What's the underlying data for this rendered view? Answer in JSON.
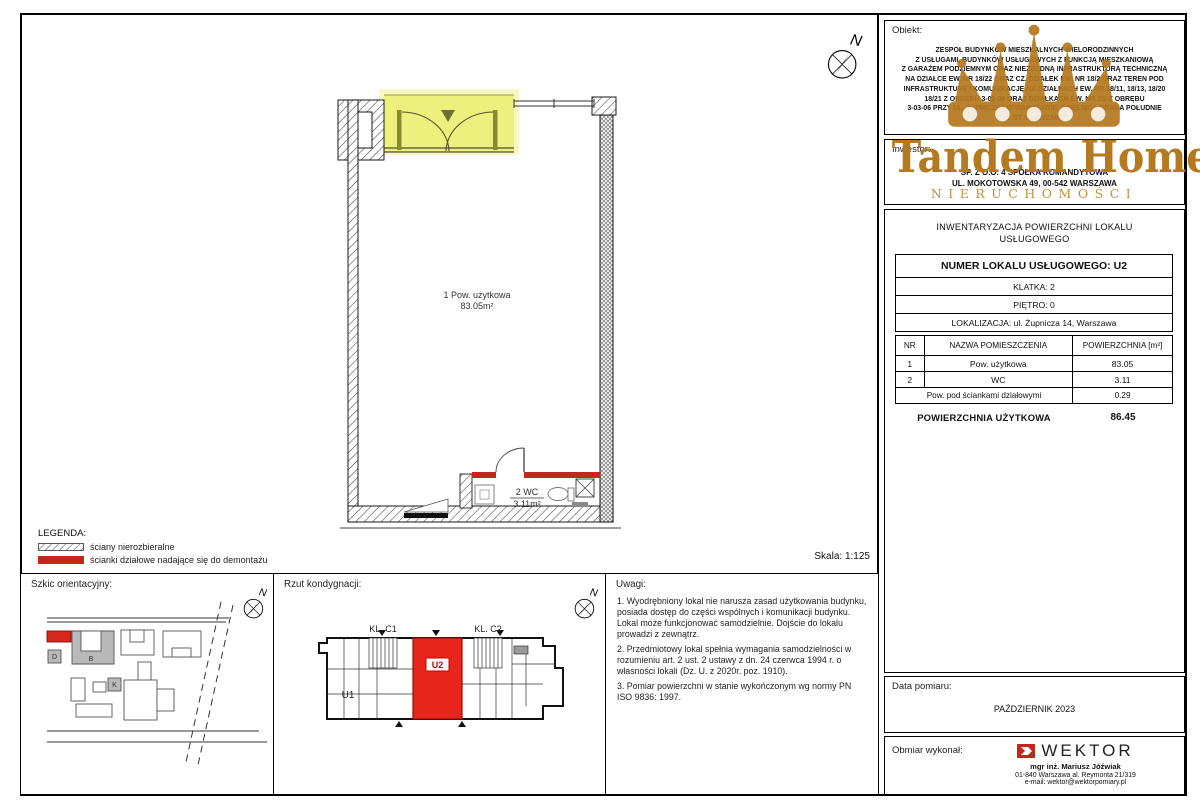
{
  "page": {
    "scale_label": "Skala: 1:125"
  },
  "colors": {
    "accent_red": "#c1271b",
    "unit_red": "#e8251a",
    "highlight_yellow": "#edf07c",
    "brand_gold": "#b5791f"
  },
  "obiekt": {
    "label": "Obiekt:",
    "lines": [
      "ZESPÓŁ BUDYNKÓW MIESZKALNYCH WIELORODZINNYCH",
      "Z USŁUGAMI, BUDYNKÓW USŁUGOWYCH Z FUNKCJĄ MIESZKANIOWĄ",
      "Z GARAŻEM PODZIEMNYM ORAZ NIEZBĘDNĄ INFRASTRUKTURĄ TECHNICZNĄ",
      "NA DZIAŁCE EW. NR 18/22 ORAZ CZ. DZIAŁEK EW. NR 18/2 ORAZ TEREN POD",
      "INFRASTRUKTURĘ I KOMUNIKACJĘ NA DZIAŁKACH EW. NR 18/11, 18/13, 18/20",
      "18/21 Z OBRĘBU 3-02-06 ORAZ DZIAŁKACH EW. NR 2/2 Z OBRĘBU",
      "3-03-06 PRZY UL. ŻUPNICZEJ W WARSZAWIE, DZIELNICA PRAGA POŁUDNIE",
      "M. ST. WARSZAWY"
    ]
  },
  "inwestor": {
    "label": "Inwestor:",
    "lines": [
      "SP. Z O.O. 4 SPÓŁKA KOMANDYTOWA",
      "UL. MOKOTOWSKA 49, 00-542 WARSZAWA"
    ]
  },
  "brand": {
    "wordmark": "Tandem Home IQ",
    "subtitle": "NIERUCHOMOŚCI"
  },
  "inventory": {
    "heading_line1": "INWENTARYZACJA POWIERZCHNI LOKALU",
    "heading_line2": "USŁUGOWEGO",
    "unit_header": "NUMER LOKALU USŁUGOWEGO: U2",
    "info_rows": [
      "KLATKA: 2",
      "PIĘTRO: 0",
      "LOKALIZACJA: ul. Żupnicza 14, Warszawa"
    ],
    "table": {
      "headers": [
        "NR",
        "NAZWA POMIESZCZENIA",
        "POWIERZCHNIA [m²]"
      ],
      "rows": [
        {
          "nr": "1",
          "name": "Pow. użytkowa",
          "area": "83.05"
        },
        {
          "nr": "2",
          "name": "WC",
          "area": "3.11"
        }
      ],
      "partition_row": {
        "name": "Pow. pod ściankami działowymi",
        "area": "0.29"
      },
      "total": {
        "label": "POWIERZCHNIA UŻYTKOWA",
        "value": "86.45"
      }
    }
  },
  "plan": {
    "north": "N",
    "room1_line1": "1 Pow. użytkowa",
    "room1_line2": "83.05m²",
    "room2_line1": "2 WC",
    "room2_line2": "3.11m²"
  },
  "legend": {
    "title": "LEGENDA:",
    "items": [
      {
        "label": "ściany nierozbieralne"
      },
      {
        "label": "ścianki działowe nadające się do demontażu"
      }
    ]
  },
  "szkic": {
    "title": "Szkic orientacyjny:",
    "labels": {
      "b": "B",
      "d": "D",
      "k": "K"
    }
  },
  "rzut": {
    "title": "Rzut kondygnacji:",
    "labels": {
      "kl_c1": "KL. C1",
      "kl_c2": "KL. C2",
      "u1": "U1",
      "u2": "U2"
    }
  },
  "uwagi": {
    "title": "Uwagi:",
    "notes": [
      "1. Wyodrębniony lokal nie narusza zasad użytkowania budynku, posiada dostęp do części wspólnych i komunikacji budynku. Lokal może funkcjonować samodzielnie. Dojście do lokalu prowadzi z zewnątrz.",
      "2. Przedmiotowy lokal spełnia wymagania samodzielności w rozumieniu art. 2 ust. 2 ustawy z dn. 24 czerwca 1994 r. o własności lokali (Dz. U. z 2020r. poz. 1910).",
      "3. Pomiar powierzchni w stanie wykończonym wg normy PN ISO 9836: 1997."
    ]
  },
  "data_pomiaru": {
    "label": "Data pomiaru:",
    "value": "PAŹDZIERNIK 2023"
  },
  "obmiar": {
    "label": "Obmiar wykonał:",
    "company": "WEKTOR",
    "person": "mgr inż. Mariusz Jóźwiak",
    "address": "01-840 Warszawa al. Reymonta 21/319",
    "email": "e-mail: wektor@wektorpomiary.pl"
  }
}
